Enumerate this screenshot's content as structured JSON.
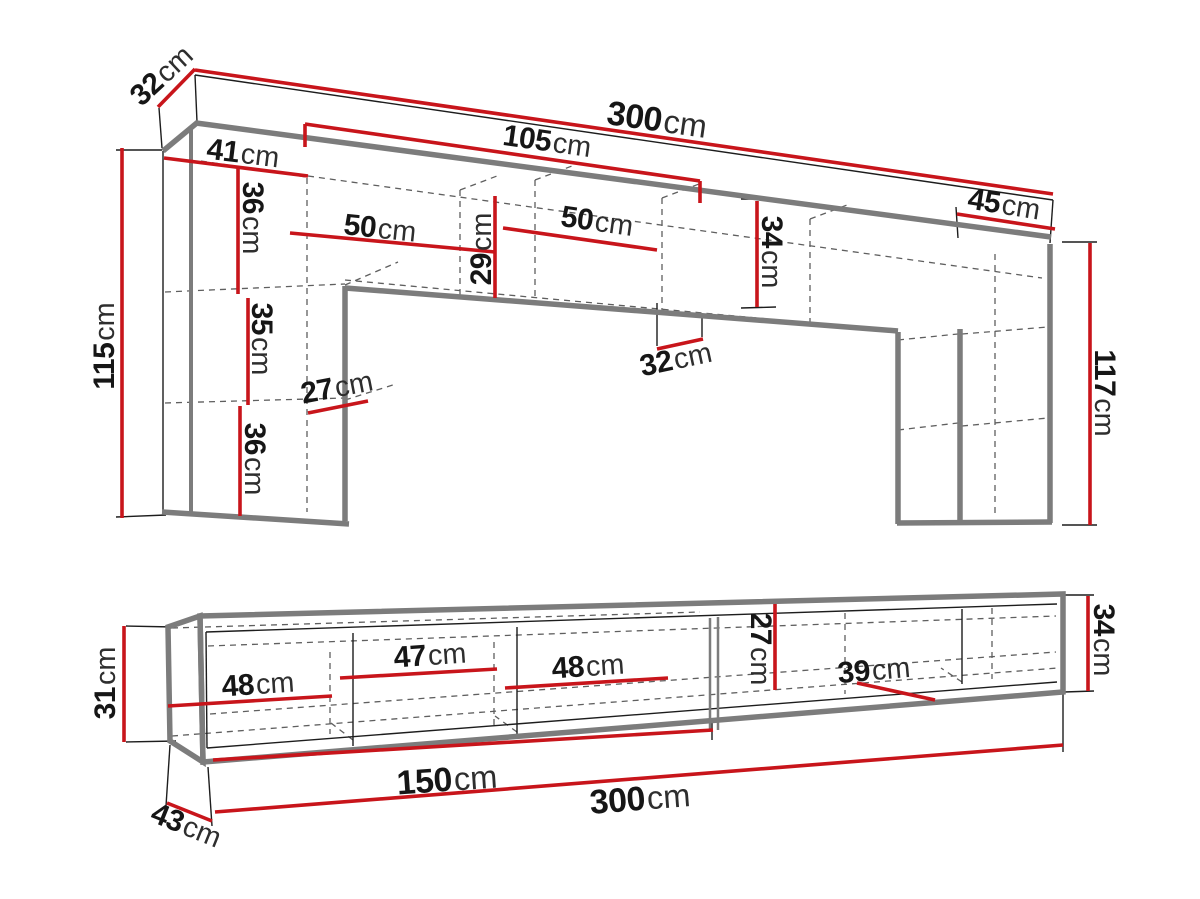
{
  "diagram": {
    "title": "wall-unit-and-tv-stand-dimension-diagram",
    "measurement_unit": "cm",
    "colors": {
      "dimension_line": "#c8151b",
      "outline_thick": "#7c7c7c",
      "outline_thin": "#1d1d1d",
      "hidden_line_dashed": "#5f5f5f",
      "background": "#ffffff",
      "label_text": "#161616"
    },
    "upper_unit": {
      "name": "wall unit upper section",
      "dimensions": {
        "top_depth": {
          "value": "32",
          "unit": "cm"
        },
        "total_width": {
          "value": "300",
          "unit": "cm"
        },
        "bridge_span": {
          "value": "105",
          "unit": "cm"
        },
        "left_column_width": {
          "value": "41",
          "unit": "cm"
        },
        "upper_shelf_height": {
          "value": "36",
          "unit": "cm"
        },
        "left_compartment_width": {
          "value": "50",
          "unit": "cm"
        },
        "bridge_inner_height": {
          "value": "29",
          "unit": "cm"
        },
        "right_compartment_width": {
          "value": "50",
          "unit": "cm"
        },
        "bridge_height": {
          "value": "34",
          "unit": "cm"
        },
        "right_column_width": {
          "value": "45",
          "unit": "cm"
        },
        "right_column_height": {
          "value": "117",
          "unit": "cm"
        },
        "left_column_height": {
          "value": "115",
          "unit": "cm"
        },
        "middle_shelf_height": {
          "value": "35",
          "unit": "cm"
        },
        "column_depth": {
          "value": "27",
          "unit": "cm"
        },
        "lower_shelf_height": {
          "value": "36",
          "unit": "cm"
        },
        "bridge_depth": {
          "value": "32",
          "unit": "cm"
        }
      }
    },
    "lower_unit": {
      "name": "tv stand lower section",
      "dimensions": {
        "left_height": {
          "value": "31",
          "unit": "cm"
        },
        "compartment_1_width": {
          "value": "48",
          "unit": "cm"
        },
        "compartment_2_width": {
          "value": "47",
          "unit": "cm"
        },
        "compartment_3_width": {
          "value": "48",
          "unit": "cm"
        },
        "inner_height": {
          "value": "27",
          "unit": "cm"
        },
        "compartment_4_width": {
          "value": "39",
          "unit": "cm"
        },
        "right_height": {
          "value": "34",
          "unit": "cm"
        },
        "half_width": {
          "value": "150",
          "unit": "cm"
        },
        "total_width": {
          "value": "300",
          "unit": "cm"
        },
        "depth": {
          "value": "43",
          "unit": "cm"
        }
      }
    }
  }
}
